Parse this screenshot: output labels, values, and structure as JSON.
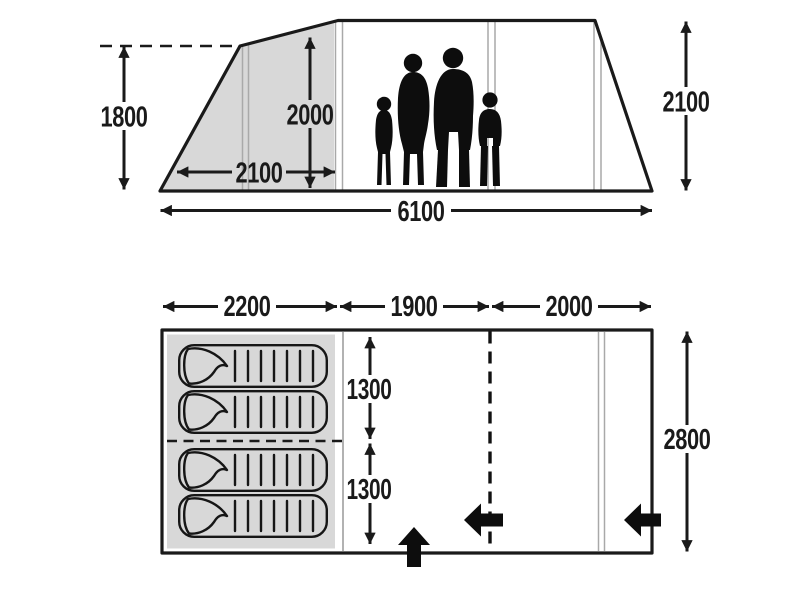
{
  "title": "Tent dimensions diagram",
  "colors": {
    "line": "#1a1a1a",
    "shaded_area": "#d8d8d8",
    "pole_line": "#a9a9a9",
    "silhouette": "#0d0d0d",
    "background": "#ffffff"
  },
  "side_view": {
    "name": "side elevation with family silhouette",
    "dims": {
      "height_front": "1800",
      "height_inner": "2000",
      "depth_bedroom": "2100",
      "length_total": "6100",
      "height_rear": "2100"
    }
  },
  "floor_plan": {
    "name": "floor plan",
    "dims": {
      "length_bedroom": "2200",
      "length_living": "1900",
      "length_front": "2000",
      "width_half_upper": "1300",
      "width_half_lower": "1300",
      "width_total": "2800"
    },
    "sleeping_bag_count": 4,
    "entrance_arrow_count": 3
  }
}
